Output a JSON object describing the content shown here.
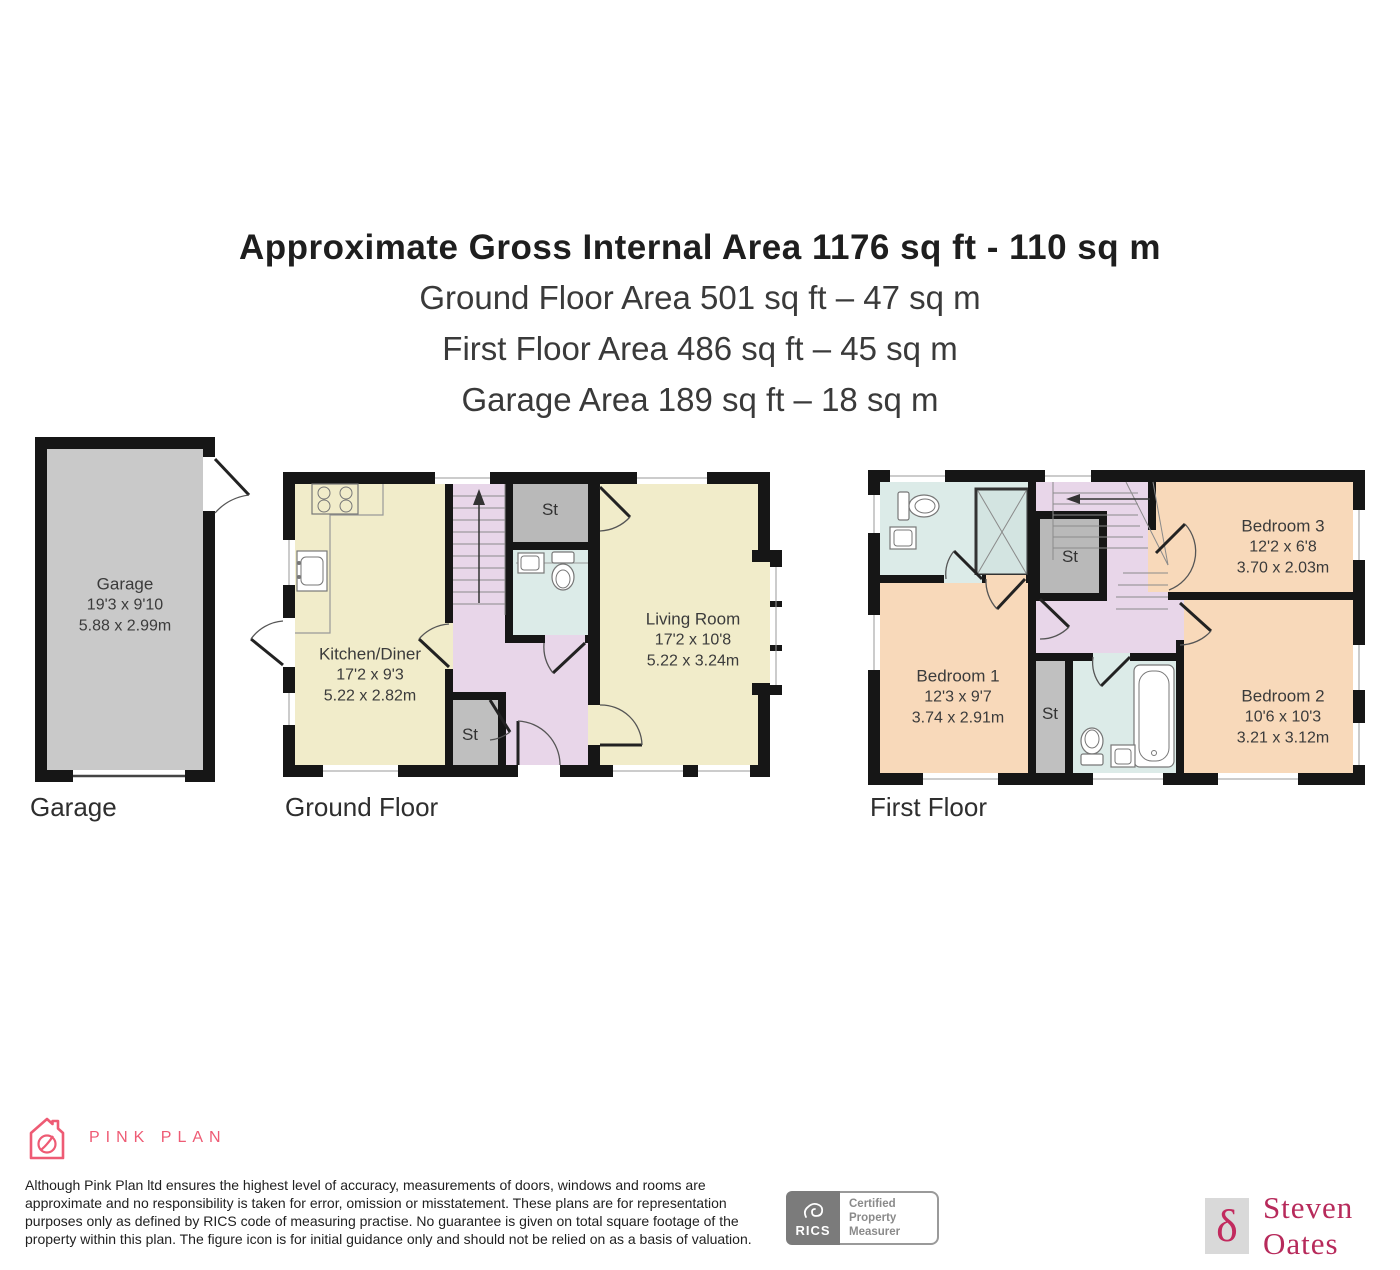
{
  "title": {
    "line1": "Approximate Gross Internal Area 1176 sq ft - 110 sq m",
    "line2": "Ground Floor Area 501 sq ft – 47 sq m",
    "line3": "First Floor Area 486 sq ft – 45 sq m",
    "line4": "Garage Area 189 sq ft – 18 sq m"
  },
  "floors": {
    "garage": {
      "caption": "Garage",
      "room": {
        "name": "Garage",
        "imperial": "19'3 x 9'10",
        "metric": "5.88 x 2.99m"
      }
    },
    "ground": {
      "caption": "Ground Floor",
      "kitchen": {
        "name": "Kitchen/Diner",
        "imperial": "17'2 x 9'3",
        "metric": "5.22 x 2.82m"
      },
      "living": {
        "name": "Living Room",
        "imperial": "17'2 x 10'8",
        "metric": "5.22 x 3.24m"
      },
      "st_top": "St",
      "st_bottom": "St"
    },
    "first": {
      "caption": "First Floor",
      "bedroom1": {
        "name": "Bedroom 1",
        "imperial": "12'3 x 9'7",
        "metric": "3.74 x 2.91m"
      },
      "bedroom2": {
        "name": "Bedroom 2",
        "imperial": "10'6 x 10'3",
        "metric": "3.21 x 3.12m"
      },
      "bedroom3": {
        "name": "Bedroom 3",
        "imperial": "12'2 x 6'8",
        "metric": "3.70 x 2.03m"
      },
      "st_top": "St",
      "st_bottom": "St"
    }
  },
  "footer": {
    "brand": "PINK PLAN",
    "disclaimer": [
      "Although Pink Plan ltd ensures the highest level of accuracy, measurements of doors, windows and rooms are",
      "approximate and no responsibility is taken for error, omission or misstatement. These plans are for representation",
      "purposes only as defined by RICS code of measuring practise. No guarantee is given on total square footage of the",
      "property within this plan. The figure icon is for initial guidance only and should not be relied on as a basis of valuation."
    ],
    "rics_label": "RICS",
    "rics_cert": [
      "Certified",
      "Property",
      "Measurer"
    ],
    "agent": "Steven Oates",
    "agent_delta_glyph": "δ"
  },
  "icons": {
    "pink_plan_logo": "house-with-leaf",
    "rics_emblem": "lion-mark",
    "agent_mark": "delta-monogram"
  },
  "colors": {
    "wall": "#161616",
    "room_cream": "#f1ecca",
    "hall_lavender": "#e8d6e9",
    "bath_blue": "#dcebe8",
    "bedroom_peach": "#f8d9ba",
    "garage_gray": "#c9c9c9",
    "closet_gray": "#b9b9b9",
    "brand_pink": "#ee5b74",
    "agent_crimson": "#b72a5b",
    "rics_gray": "#7b7b7b"
  }
}
